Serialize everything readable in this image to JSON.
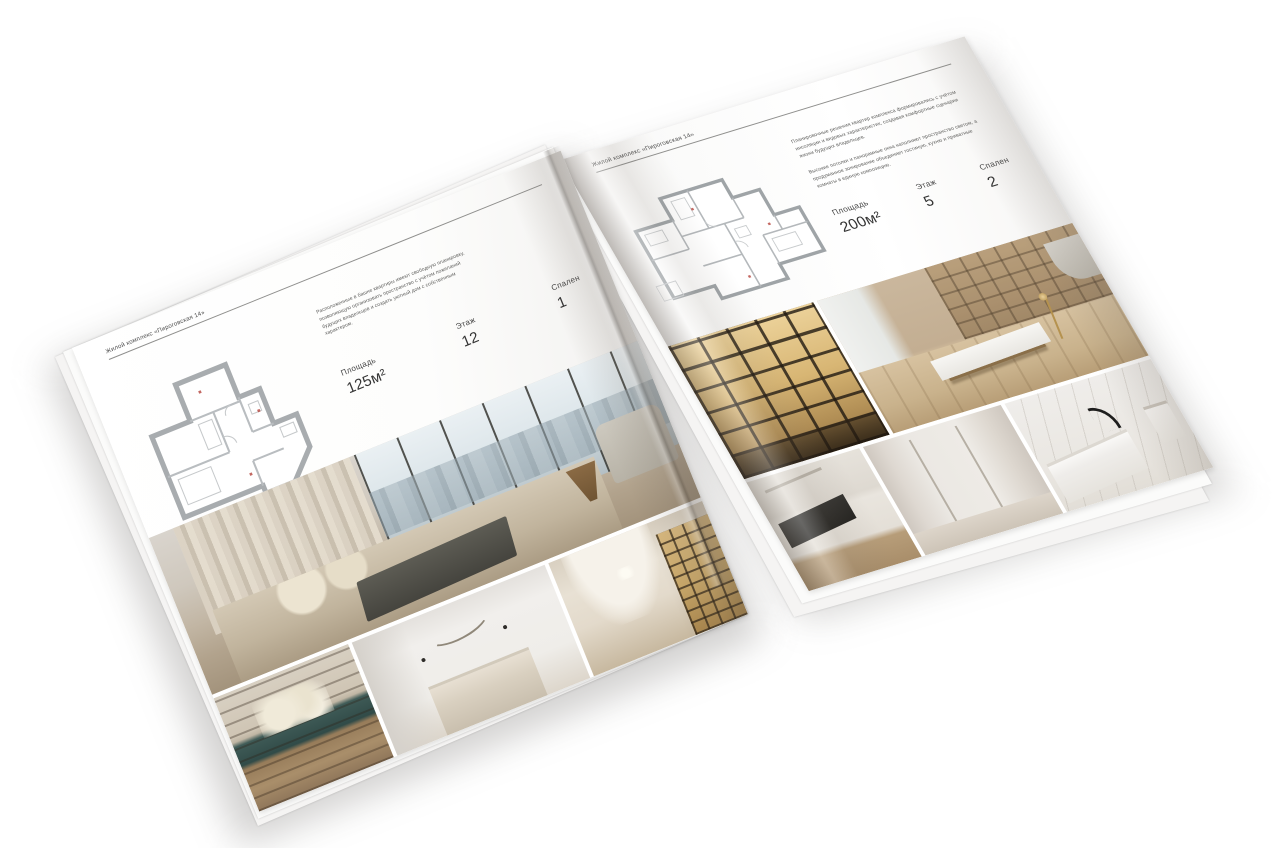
{
  "left_page": {
    "header": "Жилой комплекс «Пироговская 14»",
    "description": "Расположенные в башне квартиры имеют свободную планировку, позволяющую организовать пространство с учётом пожеланий будущих владельцев и создать уютный дом с собственным характером.",
    "stats": {
      "area_label": "Площадь",
      "area_value": "125м²",
      "floor_label": "Этаж",
      "floor_value": "12",
      "bedrooms_label": "Спален",
      "bedrooms_value": "1"
    }
  },
  "right_page": {
    "header": "Жилой комплекс «Пироговская 14»",
    "description_1": "Планировочные решения квартир комплекса формировались с учётом инсоляции и видовых характеристик, создавая комфортные сценарии жизни будущих владельцев.",
    "description_2": "Высокие потолки и панорамные окна наполняют пространство светом, а продуманное зонирование объединяет гостиную, кухню и приватные комнаты в единую композицию.",
    "stats": {
      "area_label": "Площадь",
      "area_value": "200м²",
      "floor_label": "Этаж",
      "floor_value": "5",
      "bedrooms_label": "Спален",
      "bedrooms_value": "2"
    }
  }
}
